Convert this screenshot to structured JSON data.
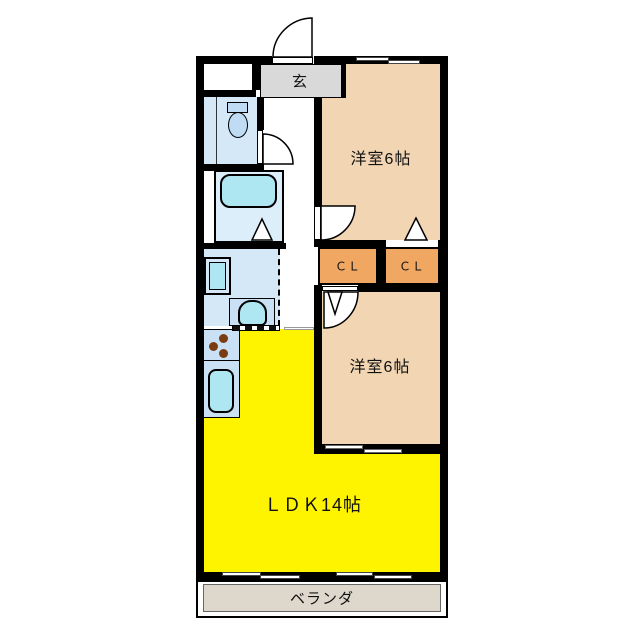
{
  "rooms": {
    "genkan": {
      "label": "玄",
      "type": "entrance-hall"
    },
    "western_room_top": {
      "label": "洋室6帖",
      "type": "bedroom",
      "size_tatami": 6
    },
    "western_room_bottom": {
      "label": "洋室6帖",
      "type": "bedroom",
      "size_tatami": 6
    },
    "closet_left": {
      "label": "ＣＬ",
      "type": "closet"
    },
    "closet_right": {
      "label": "ＣＬ",
      "type": "closet"
    },
    "ldk": {
      "label": "ＬＤＫ14帖",
      "type": "living-dining-kitchen",
      "size_tatami": 14
    },
    "veranda": {
      "label": "ベランダ",
      "type": "balcony"
    }
  },
  "fixtures": [
    "toilet",
    "bathtub",
    "washbasin",
    "washer-pan",
    "kitchen-sink",
    "stove-burners"
  ],
  "colors": {
    "wall": "#000000",
    "room-tan": "#F2D6B3",
    "room-yellow": "#FFF400",
    "closet-orange": "#F0A761",
    "genkan-gray": "#D9D9D9",
    "veranda-gray": "#DED8CC",
    "wet-blue": "#D5E8F8",
    "counter-blue": "#C9E0F5",
    "fixture-blue": "#BFDCF4",
    "fixture-cyan": "#AEE7F2",
    "burner-brown": "#7A3C12"
  }
}
